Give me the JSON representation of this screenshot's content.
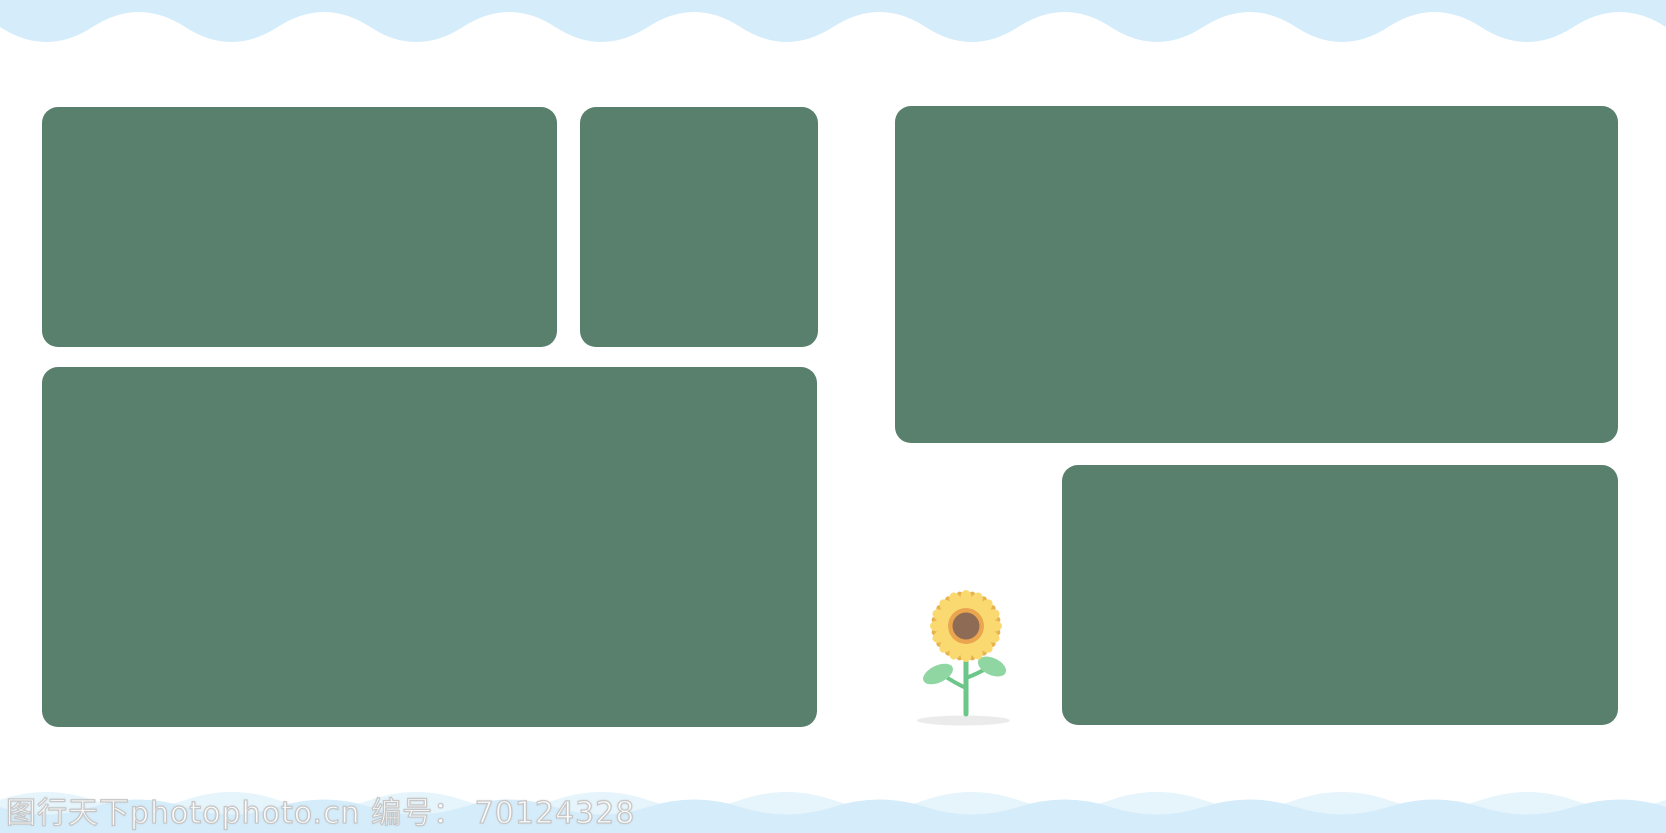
{
  "watermark": {
    "text": "图行天下photophoto.cn 编号： 70124328",
    "site_name": "图行天下photophoto.cn",
    "id_label": "编号：",
    "id_number": "70124328"
  },
  "colors": {
    "wave_blue": "#d5ecfa",
    "wave_blue_light": "#e6f4fc",
    "panel_green": "#597f6d",
    "petal_yellow": "#fada70",
    "petal_gold": "#e8b34f",
    "flower_ring_orange": "#eaa54e",
    "flower_center_brown": "#8d6b55",
    "stem_green": "#6cc689",
    "leaf_green": "#8fd6a2",
    "shadow_gray": "#ebebeb"
  },
  "illustration": {
    "name": "sunflower"
  },
  "panels": [
    {
      "id": "panel-top-left"
    },
    {
      "id": "panel-top-mid"
    },
    {
      "id": "panel-bottom-left"
    },
    {
      "id": "panel-top-right"
    },
    {
      "id": "panel-bottom-right"
    }
  ]
}
